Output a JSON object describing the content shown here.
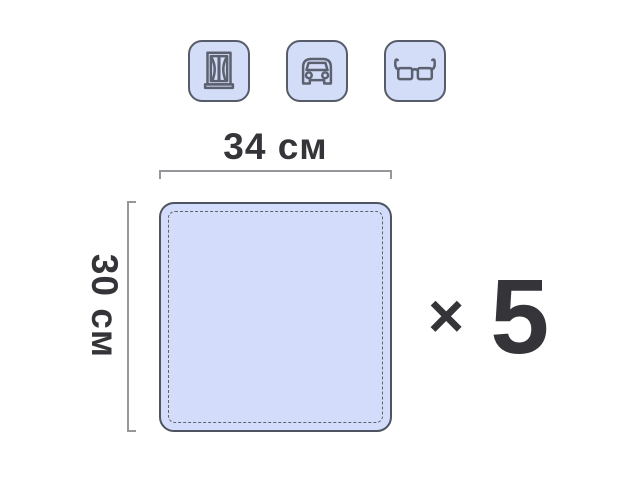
{
  "dimensions": {
    "width_label": "34 см",
    "height_label": "30 см"
  },
  "quantity": {
    "multiplier_symbol": "×",
    "count": "5"
  },
  "usage_icons": [
    {
      "id": "window-icon",
      "meaning": "window cleaning"
    },
    {
      "id": "car-icon",
      "meaning": "car cleaning"
    },
    {
      "id": "glasses-icon",
      "meaning": "glasses cleaning"
    }
  ],
  "colors": {
    "page_bg": "#ffffff",
    "tile_fill": "#d4ddf8",
    "tile_border": "#575c6a",
    "icon_stroke": "#5c6170",
    "cloth_fill": "#d3dcfa",
    "cloth_border": "#4f5462",
    "stitch": "#5e6370",
    "bracket": "#97979b",
    "text": "#353539"
  }
}
